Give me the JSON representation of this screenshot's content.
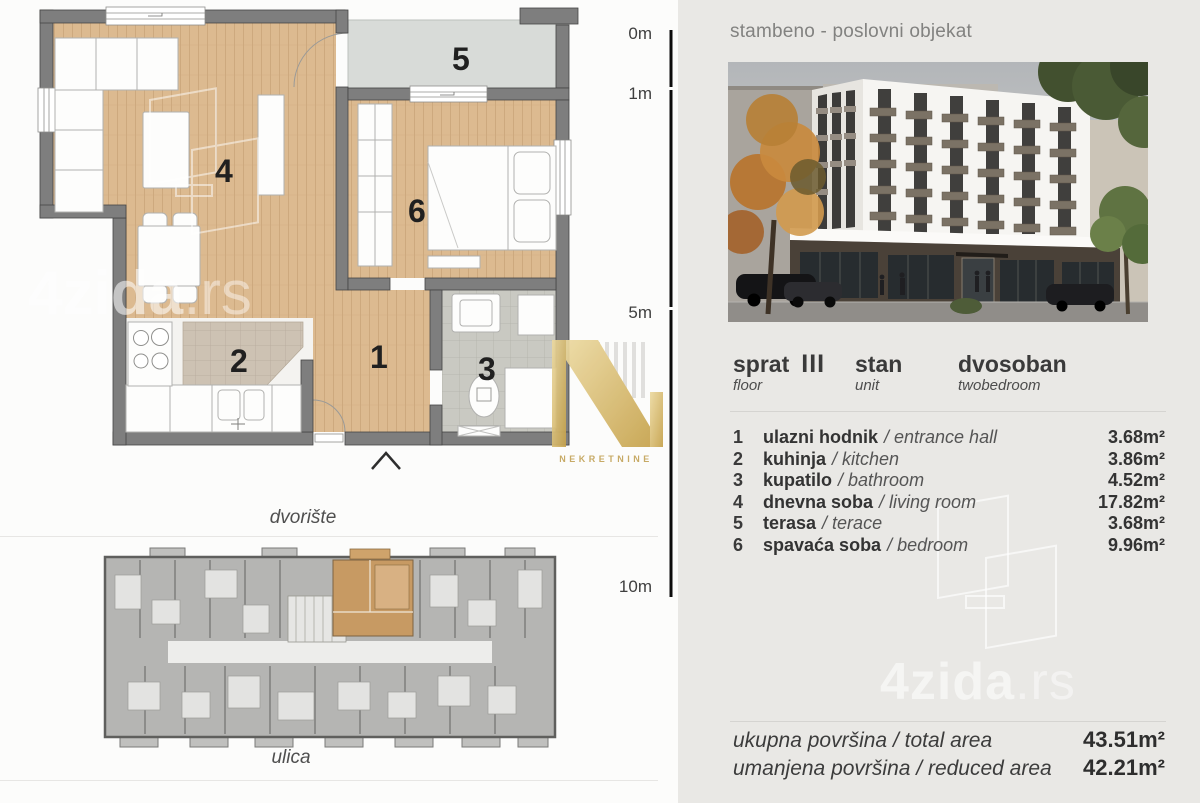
{
  "left": {
    "scale_labels": [
      "0m",
      "1m",
      "5m",
      "10m"
    ],
    "plan_numbers": [
      "1",
      "2",
      "3",
      "4",
      "5",
      "6"
    ],
    "courtyard_label": "dvorište",
    "street_label": "ulica",
    "watermark_main": "4zida",
    "watermark_ext": ".rs",
    "agency_watermark": "NEKRETNINE"
  },
  "right": {
    "title": "stambeno - poslovni objekat",
    "info": {
      "floor_label": "sprat",
      "floor_value": "III",
      "floor_sub": "floor",
      "unit_label": "stan",
      "unit_sub": "unit",
      "type_value": "dvosoban",
      "type_sub": "twobedroom"
    },
    "rooms": [
      {
        "num": "1",
        "name": "ulazni hodnik",
        "en": "/ entrance hall",
        "area": "3.68m²"
      },
      {
        "num": "2",
        "name": "kuhinja",
        "en": "/ kitchen",
        "area": "3.86m²"
      },
      {
        "num": "3",
        "name": "kupatilo",
        "en": "/ bathroom",
        "area": "4.52m²"
      },
      {
        "num": "4",
        "name": "dnevna soba",
        "en": "/ living room",
        "area": "17.82m²"
      },
      {
        "num": "5",
        "name": "terasa",
        "en": "/ terace",
        "area": "3.68m²"
      },
      {
        "num": "6",
        "name": "spavaća soba",
        "en": "/ bedroom",
        "area": "9.96m²"
      }
    ],
    "totals": [
      {
        "label": "ukupna površina / total area",
        "value": "43.51m²"
      },
      {
        "label": "umanjena površina / reduced area",
        "value": "42.21m²"
      }
    ],
    "watermark_main": "4zida",
    "watermark_ext": ".rs"
  }
}
